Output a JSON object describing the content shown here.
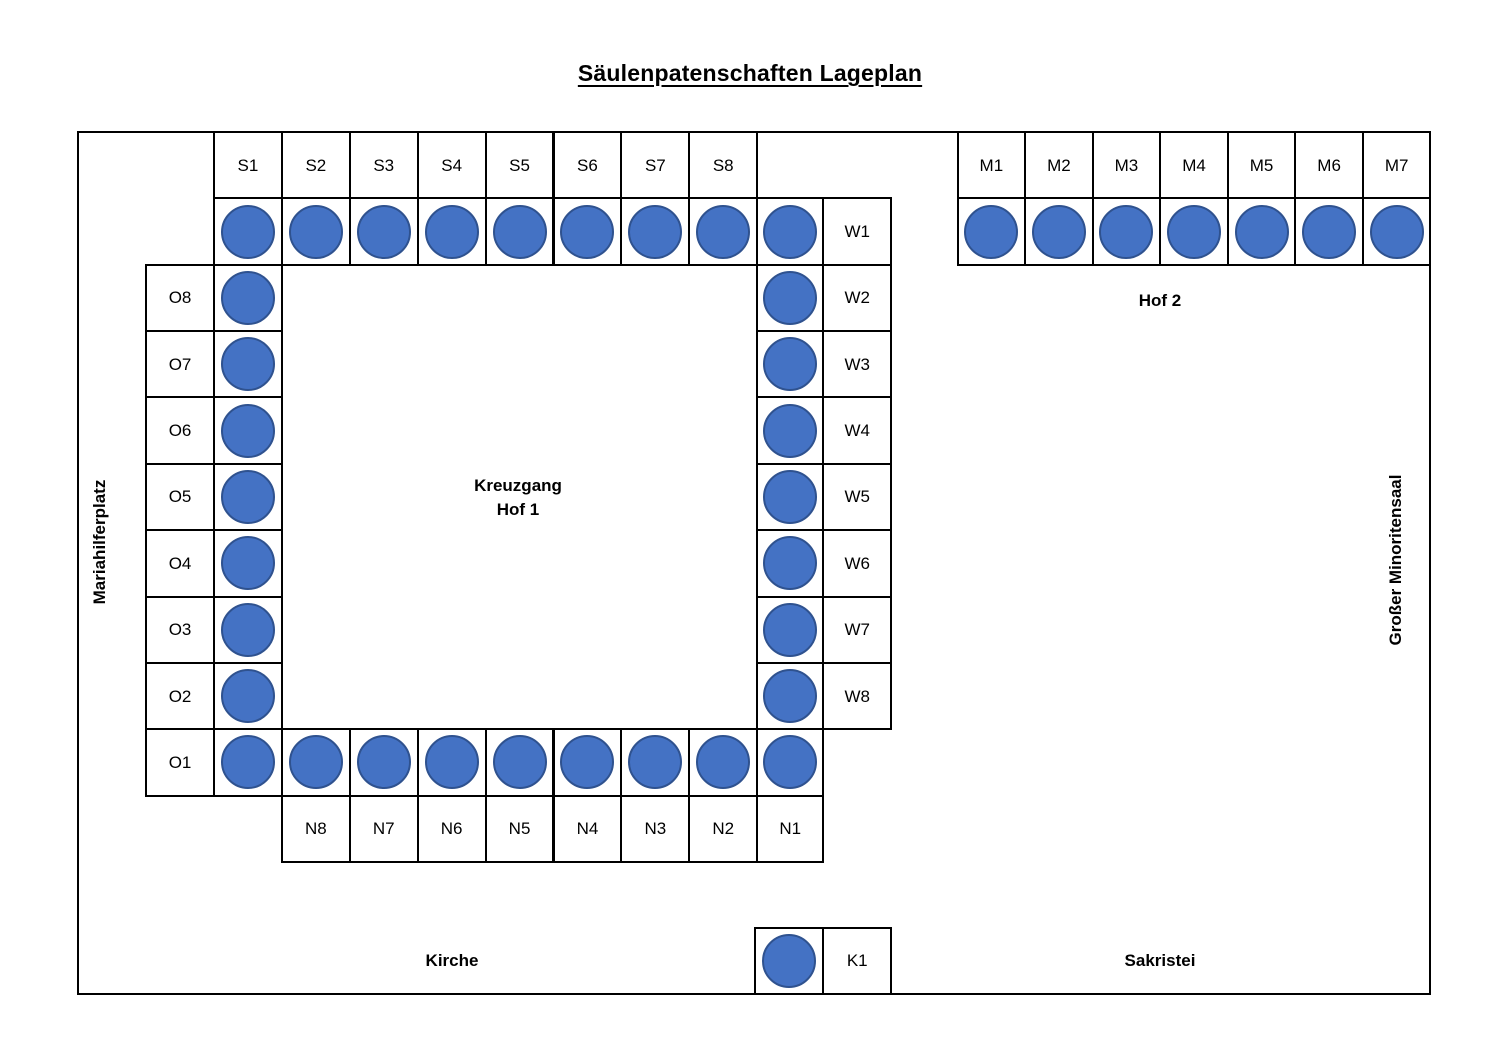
{
  "title": "Säulenpatenschaften Lageplan",
  "colors": {
    "column_fill": "#4472C4",
    "column_outline": "#2F528F",
    "grid_line": "#000000"
  },
  "areas": {
    "courtyard1": {
      "line1": "Kreuzgang",
      "line2": "Hof 1"
    },
    "courtyard2": "Hof 2",
    "west_side": "Mariahilferplatz",
    "east_side": "Großer Minoritensaal",
    "church": "Kirche",
    "sacristy": "Sakristei"
  },
  "sections": {
    "s": {
      "labels": [
        "S1",
        "S2",
        "S3",
        "S4",
        "S5",
        "S6",
        "S7",
        "S8"
      ]
    },
    "o": {
      "labels": [
        "O8",
        "O7",
        "O6",
        "O5",
        "O4",
        "O3",
        "O2",
        "O1"
      ]
    },
    "w": {
      "labels": [
        "W1",
        "W2",
        "W3",
        "W4",
        "W5",
        "W6",
        "W7",
        "W8"
      ]
    },
    "n": {
      "labels": [
        "N8",
        "N7",
        "N6",
        "N5",
        "N4",
        "N3",
        "N2",
        "N1"
      ]
    },
    "m": {
      "labels": [
        "M1",
        "M2",
        "M3",
        "M4",
        "M5",
        "M6",
        "M7"
      ]
    },
    "k": {
      "labels": [
        "K1"
      ]
    }
  }
}
